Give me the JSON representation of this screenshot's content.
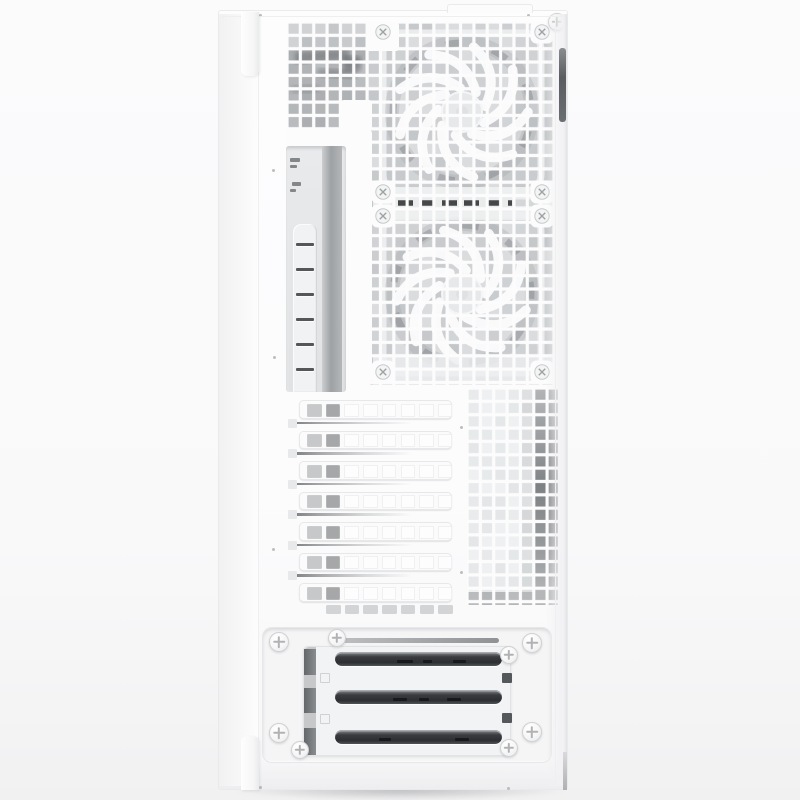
{
  "meta": {
    "subject": "White mid-tower PC case, rear panel product photo",
    "visible_text": "none",
    "features": [
      "square-hole rear mesh",
      "two white fans behind mesh",
      "vertical I/O cutout",
      "7 PCI expansion slot covers",
      "side vent grid",
      "PSU mount bracket with 3 dark slots",
      "white Phillips thumbscrews"
    ]
  },
  "canvas": {
    "w": 800,
    "h": 800
  },
  "palette": {
    "bg": "#fbfbfc",
    "panel": "#fcfcfd",
    "panel_edge": "#e9eaeb",
    "seam": "#efeff0",
    "hole_base": "#dadcde",
    "grid_bar": "#fcfcfd",
    "dark_slot": "#37393c",
    "screw_border": "#cfd1d2",
    "screw_cross": "#b0b2b4",
    "dot": "#b1b3b5",
    "handle_dark": "#5a5d60"
  },
  "case": {
    "x": 218,
    "y": 10,
    "w": 350,
    "h": 780,
    "top_lip_y": 16,
    "seam_left_x": 258,
    "seam_right_x": 555,
    "top_tab": {
      "x": 447,
      "y": 4,
      "w": 84,
      "h": 8
    },
    "latch_top": {
      "x": 241,
      "y": 12,
      "w": 18,
      "h": 64
    },
    "latch_bottom": {
      "x": 241,
      "y": 736,
      "w": 18,
      "h": 54
    },
    "handle": {
      "x": 559,
      "y": 48,
      "w": 7,
      "h": 74
    },
    "edge_notch": {
      "x": 563,
      "y": 752,
      "w": 4,
      "h": 38
    }
  },
  "mesh": {
    "x": 287,
    "y": 22,
    "w": 268,
    "h": 363,
    "pitch": 13.35,
    "bar": 3.15,
    "seed": 7,
    "left_block": {
      "w": 80,
      "h": 108,
      "fill": "#d0d2d4"
    },
    "smudges": [
      {
        "x": 8,
        "y": 28,
        "w": 55,
        "h": 12,
        "rot": -4,
        "c": "#5f6265",
        "o": 0.5
      },
      {
        "x": 30,
        "y": 47,
        "w": 40,
        "h": 9,
        "rot": 3,
        "c": "#6a6d70",
        "o": 0.45
      },
      {
        "x": 4,
        "y": 63,
        "w": 28,
        "h": 8,
        "rot": -2,
        "c": "#7c7f82",
        "o": 0.4
      },
      {
        "x": 56,
        "y": 34,
        "w": 18,
        "h": 15,
        "rot": 0,
        "c": "#4c4f52",
        "o": 0.45
      }
    ],
    "junction": {
      "x1": 111,
      "x2": 243,
      "y": 181,
      "band": {
        "x": 86,
        "y": 165,
        "w": 180,
        "h": 33
      },
      "light_tail": {
        "x": 225,
        "y": 177.5,
        "w": 26,
        "h": 6.5
      }
    },
    "bottom_band": {
      "x": 86,
      "y": 334,
      "w": 180,
      "h": 29
    },
    "white_patches": [
      {
        "x": 0,
        "y": 108,
        "w": 85,
        "h": 255
      },
      {
        "x": 54,
        "y": 78,
        "w": 31,
        "h": 31
      },
      {
        "x": 79,
        "y": 0,
        "w": 33,
        "h": 29
      }
    ],
    "screw_patch_size": 23,
    "fan_screws": [
      {
        "x": 96,
        "y": 10
      },
      {
        "x": 255,
        "y": 10
      },
      {
        "x": 96,
        "y": 170
      },
      {
        "x": 255,
        "y": 170
      },
      {
        "x": 96,
        "y": 194
      },
      {
        "x": 255,
        "y": 194
      },
      {
        "x": 96,
        "y": 350
      },
      {
        "x": 255,
        "y": 350
      }
    ]
  },
  "fans": {
    "cx": 175,
    "blades": 9,
    "r_frame": 79,
    "r_blade_out": 66,
    "r_hub": 20,
    "list": [
      {
        "cy": 90
      },
      {
        "cy": 272
      }
    ],
    "blade_color": "#fdfdfe",
    "hub_fill": "#e6e8ea",
    "frame_color": "#f0f1f2",
    "ring_color": "#9fa2a5"
  },
  "io": {
    "x": 286,
    "y": 146,
    "w": 60,
    "h": 246,
    "bg1": "#e9eaec",
    "bg2": "#e0e2e4",
    "strip": {
      "x": 36,
      "w": 20,
      "c1": "#cbced0",
      "c2": "#9ea1a3",
      "c3": "#b4b6b8"
    },
    "marks": [
      {
        "x": 4,
        "y": 12,
        "w": 10,
        "h": 4
      },
      {
        "x": 4,
        "y": 19,
        "w": 7,
        "h": 3
      },
      {
        "x": 6,
        "y": 36,
        "w": 9,
        "h": 4
      },
      {
        "x": 4,
        "y": 43,
        "w": 6,
        "h": 3
      }
    ],
    "mark_color": "#84878a",
    "bar": {
      "x": 7,
      "y": 78,
      "w": 24,
      "color": "#f1f2f3",
      "slot_x": 3,
      "slot_w": 18,
      "slot_h": 2.8,
      "first_slot_y": 19,
      "slot_pitch": 25,
      "slot_count": 6,
      "slot_color": "#54575a"
    }
  },
  "pci": {
    "x": 288,
    "y": 394,
    "w": 172,
    "h": 224,
    "cover": {
      "x": 11,
      "w": 153,
      "h": 18.5,
      "r": 4.5
    },
    "first_y": 6,
    "pitch": 30.5,
    "count": 7,
    "holes": {
      "count": 8,
      "w": 14.6,
      "h": 13,
      "x0": 7,
      "pitch": 18.7,
      "y_off": 2.7,
      "colors": [
        "#c6c8ca",
        "#a5a7a9",
        "#fdfdfe",
        "#fdfdfe",
        "#fdfdfe",
        "#fdfdfe",
        "#fdfdfe",
        "#fdfdfe"
      ]
    },
    "groove": {
      "x": 6,
      "w": 158,
      "h": 2.6,
      "first_y": 27.6,
      "pitch": 30.5,
      "count": 6,
      "g1": "#7e8184",
      "g2": "#a9abad",
      "g3": "#d7d9da"
    },
    "rail": {
      "w": 9,
      "h": 9,
      "fill": "#e8e9ea"
    },
    "bottom_vents": {
      "count": 7,
      "x0": 38,
      "y": 211,
      "w": 14.6,
      "h": 9,
      "pitch": 18.7,
      "fill": "#d2d4d6"
    }
  },
  "vent": {
    "x": 467,
    "y": 388,
    "w": 91,
    "h": 217,
    "pitch": 13.35,
    "bar": 3.15,
    "seed": 11,
    "base": "#eef0f1",
    "mid_x": 53,
    "mid_w": 13,
    "dark_x": 66,
    "dark_w": 25,
    "bottom_h": 13,
    "bottom_fill": "#b9bbbd"
  },
  "psu": {
    "x": 262,
    "y": 627,
    "w": 290,
    "h": 136,
    "r": 10,
    "bg": "#f5f5f6",
    "border": "#e6e7e8",
    "bar": {
      "x": 80,
      "y": 10,
      "w": 156,
      "h": 5,
      "c1": "#bbbdbf",
      "c2": "#8f9295"
    },
    "plate": {
      "x": 40,
      "y": 18,
      "w": 208,
      "h": 110,
      "r": 5,
      "bg": "#f2f3f4",
      "border": "#e2e3e4",
      "col": {
        "w": 12,
        "light": "#c6c8ca",
        "dark": "#64676a",
        "segs": [
          {
            "y": 2,
            "h": 26
          },
          {
            "y": 41,
            "h": 25
          },
          {
            "y": 81,
            "h": 27
          }
        ]
      },
      "slot": {
        "x": 31,
        "w": 167,
        "h": 14,
        "r": 7,
        "g1": "#8b8e91",
        "g2": "#3a3c3f",
        "g3": "#2c2e31",
        "g4": "#515457"
      },
      "slots_y": [
        5,
        43,
        83
      ],
      "slot_marks": [
        [
          {
            "x": 62,
            "w": 16
          },
          {
            "x": 88,
            "w": 9
          },
          {
            "x": 118,
            "w": 13
          }
        ],
        [
          {
            "x": 58,
            "w": 14
          },
          {
            "x": 84,
            "w": 10
          },
          {
            "x": 112,
            "w": 14
          }
        ],
        [
          {
            "x": 44,
            "w": 12
          },
          {
            "x": 120,
            "w": 14
          }
        ]
      ],
      "sq_dark": [
        {
          "x": 198,
          "y": 26
        },
        {
          "x": 198,
          "y": 66
        }
      ],
      "sq_light": [
        {
          "x": 16,
          "y": 26
        },
        {
          "x": 16,
          "y": 67
        }
      ],
      "sq_size": 10,
      "sq_dark_fill": "#55585a",
      "sq_light_border": "#cfd1d3"
    }
  },
  "screws": {
    "thumb": [
      {
        "cx": 237,
        "cy": 84,
        "r": 10
      },
      {
        "cx": 236,
        "cy": 749,
        "r": 10
      },
      {
        "cx": 557,
        "cy": 22,
        "r": 9
      },
      {
        "cx": 279,
        "cy": 642,
        "r": 10
      },
      {
        "cx": 532,
        "cy": 643,
        "r": 10
      },
      {
        "cx": 279,
        "cy": 733,
        "r": 10
      },
      {
        "cx": 532,
        "cy": 732,
        "r": 10
      },
      {
        "cx": 337,
        "cy": 638,
        "r": 9
      },
      {
        "cx": 509,
        "cy": 655,
        "r": 9
      },
      {
        "cx": 300,
        "cy": 750,
        "r": 9
      },
      {
        "cx": 509,
        "cy": 748,
        "r": 9
      }
    ]
  },
  "dots": [
    {
      "x": 260,
      "y": 15
    },
    {
      "x": 528,
      "y": 15
    },
    {
      "x": 273,
      "y": 170
    },
    {
      "x": 274,
      "y": 357
    },
    {
      "x": 273,
      "y": 549
    },
    {
      "x": 461,
      "y": 427
    },
    {
      "x": 461,
      "y": 572
    },
    {
      "x": 260,
      "y": 787
    },
    {
      "x": 508,
      "y": 788
    }
  ],
  "shadow": {
    "x": 230,
    "y": 786,
    "w": 340,
    "h": 14
  }
}
